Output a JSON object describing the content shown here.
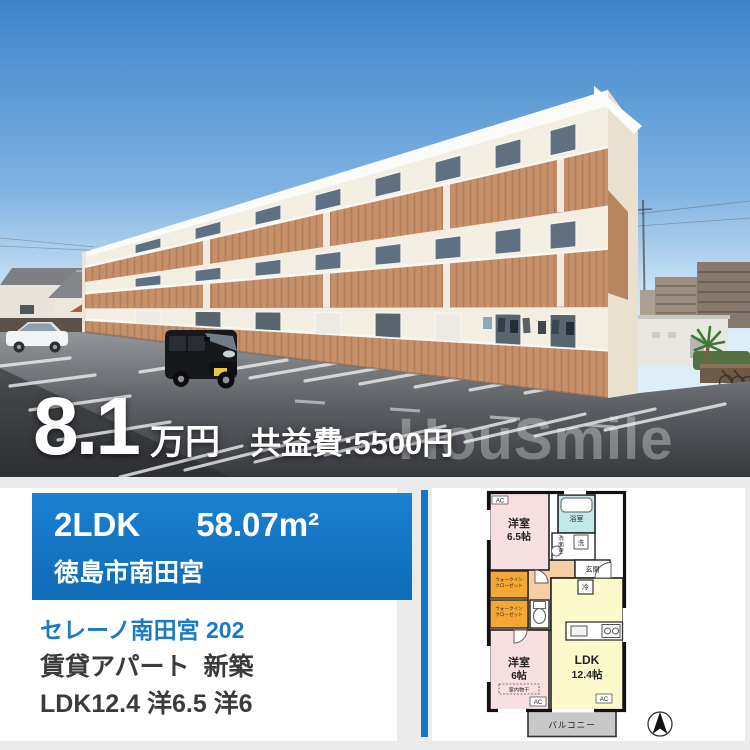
{
  "photo": {
    "price": "8.1",
    "price_unit": "万円",
    "fee": "共益費:5500円",
    "watermark": "HouSmile"
  },
  "info": {
    "layout_type": "2LDK",
    "area": "58.07m²",
    "location": "徳島市南田宮",
    "title": "セレーノ南田宮 202",
    "building_type": "賃貸アパート",
    "condition": "新築",
    "rooms": "LDK12.4 洋6.5 洋6"
  },
  "floorplan": {
    "bedroom_a_name": "洋室",
    "bedroom_a_size": "6.5帖",
    "bedroom_b_name": "洋室",
    "bedroom_b_size": "6帖",
    "ldk_name": "LDK",
    "ldk_size": "12.4帖",
    "bath": "浴室",
    "washroom_chars": [
      "洗",
      "面",
      "室"
    ],
    "washer": "洗",
    "entrance": "玄関",
    "fridge": "冷",
    "wic_line1": "ウォークイン",
    "wic_line2": "クローゼット",
    "indoor_drying": "室内物干",
    "balcony": "バルコニー",
    "ac": "AC"
  },
  "colors": {
    "accent_blue": "#1478c8",
    "link_blue": "#1b79c6",
    "terracotta": "#c6906a",
    "sky_top": "#3d84c9"
  }
}
